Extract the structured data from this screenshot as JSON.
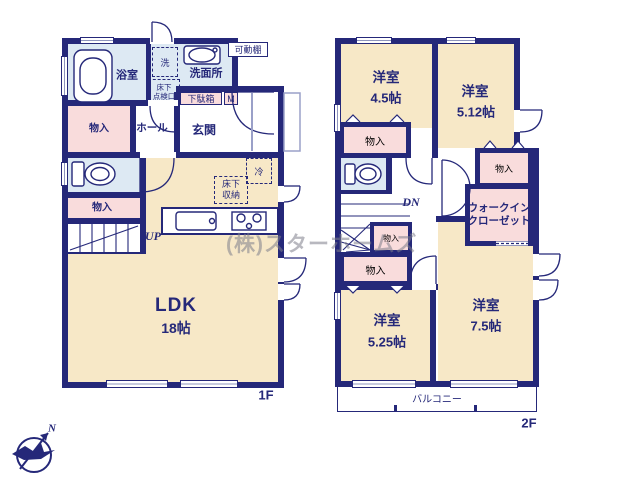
{
  "watermark": "(株)スターホームズ",
  "compass": {
    "north": "N"
  },
  "colors": {
    "wall": "#252879",
    "room_cream": "#f7e8c7",
    "room_blue": "#dde9f3",
    "room_pink": "#f9dcdc",
    "text": "#252879"
  },
  "floor1": {
    "floor_label": "1F",
    "ldk": {
      "name": "LDK",
      "size": "18帖"
    },
    "bathroom": "浴室",
    "laundry": "洗",
    "underfloor_hatch": {
      "line1": "床下",
      "line2": "点検口"
    },
    "washroom": "洗面所",
    "movable_shelf": "可動棚",
    "shoe_box": {
      "name": "下駄箱",
      "tag": "M"
    },
    "entrance": "玄関",
    "hall": "ホール",
    "storage_upper": "物入",
    "storage_lower": "物入",
    "stairs_label": "UP",
    "refrigerator": "冷",
    "underfloor_storage": {
      "line1": "床下",
      "line2": "収納"
    }
  },
  "floor2": {
    "floor_label": "2F",
    "room_a": {
      "name": "洋室",
      "size": "4.5帖"
    },
    "room_b": {
      "name": "洋室",
      "size": "5.12帖"
    },
    "room_c": {
      "name": "洋室",
      "size": "5.25帖"
    },
    "room_d": {
      "name": "洋室",
      "size": "7.5帖"
    },
    "closet_a": "物入",
    "closet_b": "物入",
    "closet_c": "物入",
    "closet_d": "物入",
    "walk_in_closet": {
      "line1": "ウォークイン",
      "line2": "クローゼット"
    },
    "stairs_label": "DN",
    "balcony": "バルコニー"
  }
}
